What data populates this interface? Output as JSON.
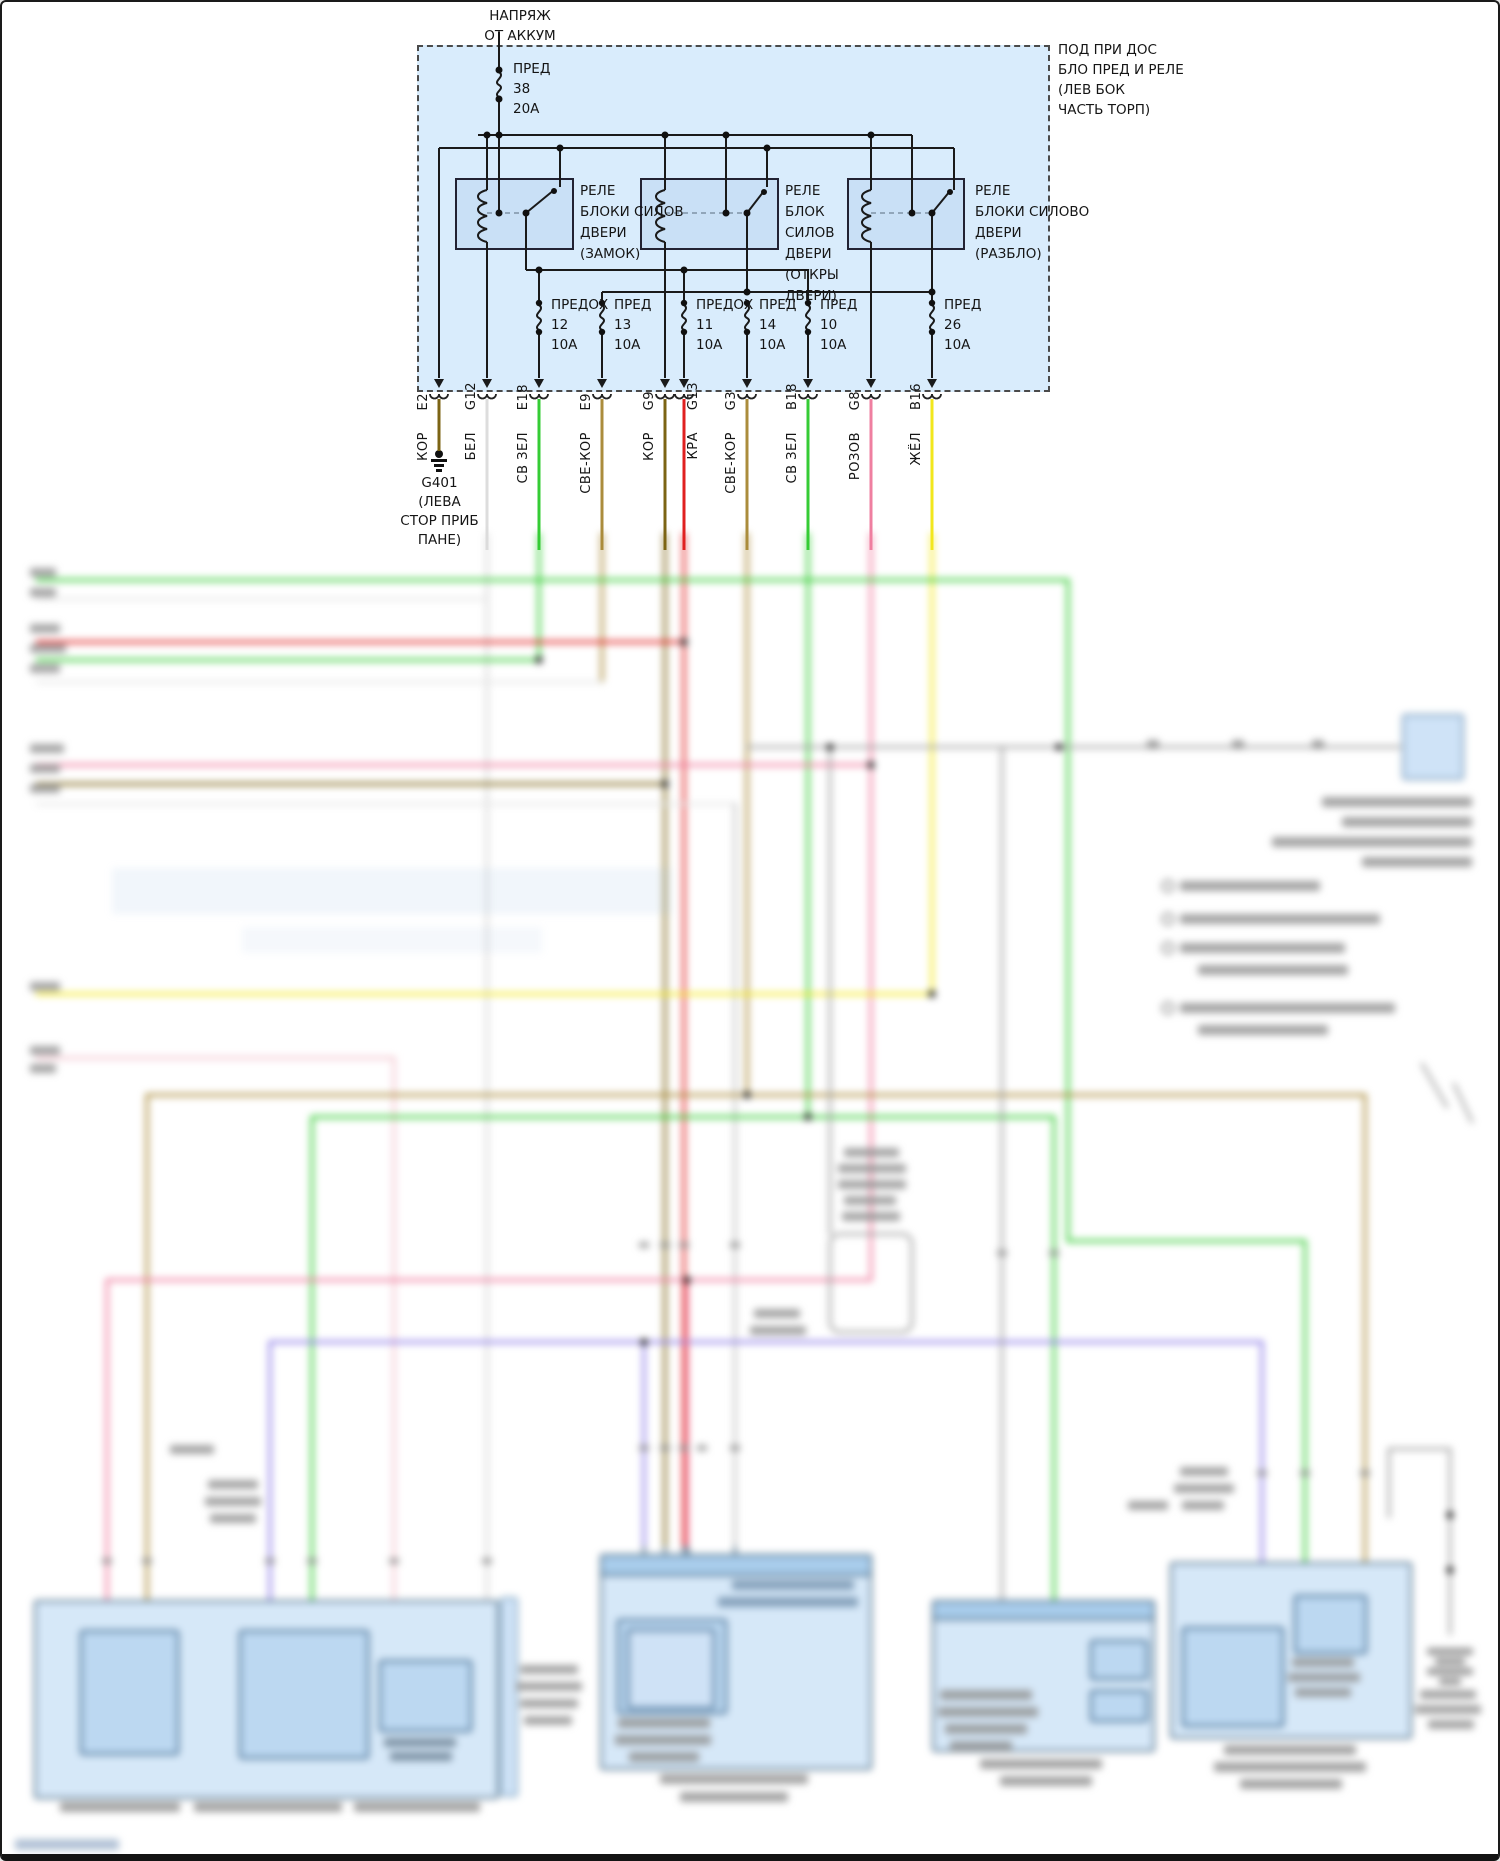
{
  "fusebox": {
    "source_label": "НАПРЯЖ\nОТ АККУМ",
    "location_label": "ПОД ПРИ ДОС\nБЛО ПРЕД И РЕЛЕ\n(ЛЕВ БОК\nЧАСТЬ ТОРП)",
    "main_fuse": {
      "label": "ПРЕД",
      "number": "38",
      "rating": "20А"
    },
    "relays": [
      {
        "label": "РЕЛЕ\nБЛОКИ СИЛОВ\nДВЕРИ\n(ЗАМОК)"
      },
      {
        "label": "РЕЛЕ\nБЛОК\nСИЛОВ\nДВЕРИ\n(ОТКРЫ\nДВЕРИ)"
      },
      {
        "label": "РЕЛЕ\nБЛОКИ СИЛОВО\nДВЕРИ\n(РАЗБЛО)"
      }
    ],
    "fuses": [
      {
        "label": "ПРЕДОХ",
        "number": "12",
        "rating": "10А"
      },
      {
        "label": "ПРЕД",
        "number": "13",
        "rating": "10А"
      },
      {
        "label": "ПРЕДОХ",
        "number": "11",
        "rating": "10А"
      },
      {
        "label": "ПРЕД",
        "number": "14",
        "rating": "10А"
      },
      {
        "label": "ПРЕД",
        "number": "10",
        "rating": "10А"
      },
      {
        "label": "ПРЕД",
        "number": "26",
        "rating": "10А"
      }
    ]
  },
  "connectors": [
    {
      "pin": "E2",
      "color_label": "КОР",
      "color": "#7c6414"
    },
    {
      "pin": "G12",
      "color_label": "БЕЛ",
      "color": "#dddddd"
    },
    {
      "pin": "E18",
      "color_label": "СВ ЗЕЛ",
      "color": "#35cc35"
    },
    {
      "pin": "E9",
      "color_label": "СВЕ-КОР",
      "color": "#ab8c3c"
    },
    {
      "pin": "G9",
      "color_label": "КОР",
      "color": "#7c6414"
    },
    {
      "pin": "G13",
      "color_label": "КРА",
      "color": "#e02020"
    },
    {
      "pin": "G3",
      "color_label": "СВЕ-КОР",
      "color": "#ab8c3c"
    },
    {
      "pin": "B18",
      "color_label": "СВ ЗЕЛ",
      "color": "#35cc35"
    },
    {
      "pin": "G8",
      "color_label": "РОЗОВ",
      "color": "#ef7fa0"
    },
    {
      "pin": "B16",
      "color_label": "ЖЁЛ",
      "color": "#f2e71d"
    }
  ],
  "ground": {
    "id": "G401",
    "location": "(ЛЕВА\nСТОР ПРИБ\nПАНЕ)"
  },
  "colors": {
    "box_fill": "#d9ecfc",
    "relay_fill": "#c9e0f6",
    "component_fill": "#d6e8f8",
    "component_inner": "#bcd8f1",
    "wire_yellow": "#f2e71d",
    "wire_purple": "#8f7fe8",
    "wire_pink": "#ef7fa0",
    "wire_green": "#35cc35",
    "wire_red": "#e02020",
    "wire_brown": "#7c6414"
  }
}
